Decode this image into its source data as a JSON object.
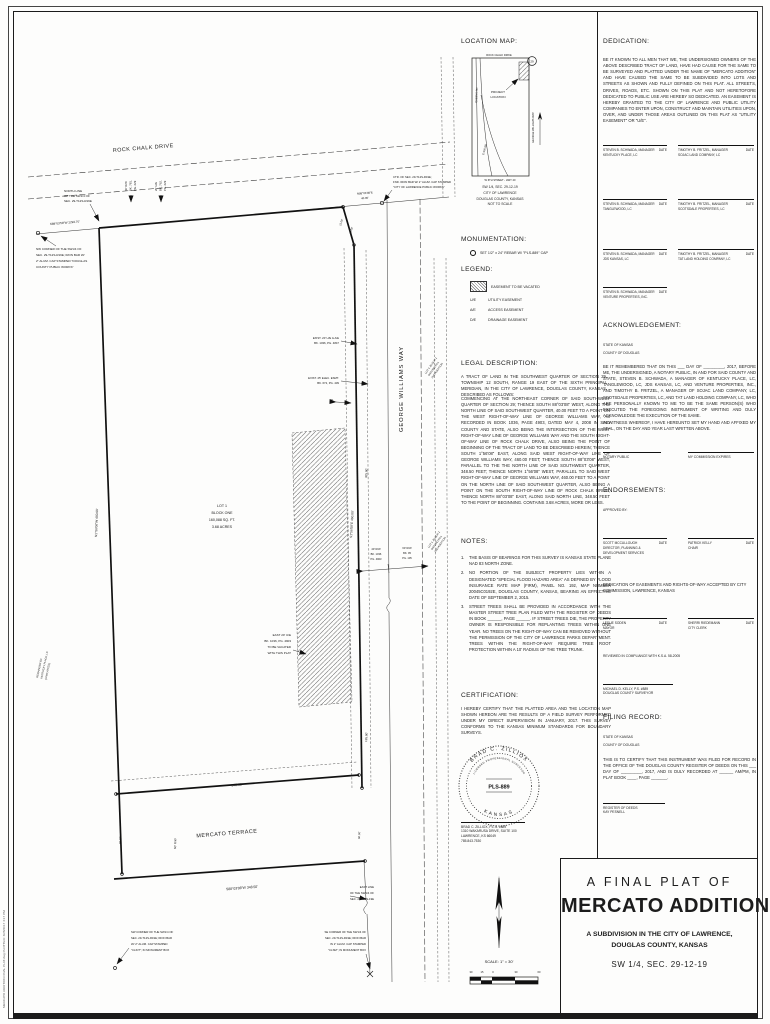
{
  "sheet": {
    "plot_stamp": "MERCATO ADDITION FINAL PLAT.dwg    PLOTTED: 3/28/2017 3:17 PM"
  },
  "labels": {
    "date": "DATE"
  },
  "location_map": {
    "title": "LOCATION MAP:",
    "road_top": "ROCK CHALK DRIVE",
    "badge": "29",
    "project_1": "PROJECT",
    "project_2": "LOCATION",
    "street_right": "GEORGE WILLIAMS WAY",
    "street_left_a": "QUEENS RD",
    "street_left_b": "E 900 RD",
    "road_bottom": "W 6TH STREET - HWY 40",
    "caption": [
      "SW 1/4, SEC. 29-12-19",
      "CITY OF LAWRENCE",
      "DOUGLAS COUNTY, KANSAS",
      "NOT TO SCALE"
    ]
  },
  "monumentation": {
    "title": "MONUMENTATION:",
    "item": "SET 1/2\" x 24\" REBAR W/ \"PLS-889\" CAP"
  },
  "legend": {
    "title": "LEGEND:",
    "vacated": "EASEMENT TO BE VACATED",
    "items": [
      {
        "code": "U/E",
        "label": "UTILITY EASEMENT"
      },
      {
        "code": "A/E",
        "label": "ACCESS EASEMENT"
      },
      {
        "code": "D/E",
        "label": "DRAINAGE EASEMENT"
      }
    ]
  },
  "legal": {
    "title": "LEGAL DESCRIPTION:",
    "p1": "A TRACT OF LAND IN THE SOUTHWEST QUARTER OF SECTION 29, TOWNSHIP 12 SOUTH, RANGE 19 EAST OF THE SIXTH PRINCIPAL MERIDIAN, IN THE CITY OF LAWRENCE, DOUGLAS COUNTY, KANSAS, DESCRIBED AS FOLLOWS:",
    "p2": "COMMENCING AT THE NORTHEAST CORNER OF SAID SOUTHWEST QUARTER OF SECTION 29; THENCE SOUTH 88°03'08\" WEST, ALONG THE NORTH LINE OF SAID SOUTHWEST QUARTER, 40.00 FEET TO A POINT ON THE WEST RIGHT-OF-WAY LINE OF GEORGE WILLIAMS WAY, AS RECORDED IN BOOK 1036, PAGE 4903, DATED MAY 4, 2008 IN SAID COUNTY AND STATE, ALSO BEING THE INTERSECTION OF THE WEST RIGHT-OF-WAY LINE OF GEORGE WILLIAMS WAY AND THE SOUTH RIGHT-OF-WAY LINE OF ROCK CHALK DRIVE, ALSO BEING THE POINT OF BEGINNING OF THE TRACT OF LAND TO BE DESCRIBED HEREIN; THENCE SOUTH 1°56'08\" EAST, ALONG SAID WEST RIGHT-OF-WAY LINE OF GEORGE WILLIAMS WAY, 460.00 FEET; THENCE SOUTH 88°03'08\" WEST, PARALLEL TO THE THE NORTH LINE OF SAID SOUTHWEST QUARTER, 348.50 FEET; THENCE NORTH 1°56'08\" WEST, PARALLEL TO SAID WEST RIGHT-OF-WAY LINE OF GEORGE WILLIAMS WAY, 460.00 FEET TO A POINT ON THE NORTH LINE OF SAID SOUTHWEST QUARTER, ALSO BEING A POINT ON THE SOUTH RIGHT-OF-WAY LINE OF ROCK CHALK DRIVE; THENCE NORTH 88°03'08\" EAST, ALONG SAID NORTH LINE, 348.50 FEET TO THE POINT OF BEGINNING. CONTAINS 3.68 ACRES, MORE OR LESS."
  },
  "notes": {
    "title": "NOTES:",
    "items": [
      {
        "n": "1.",
        "t": "THE BASIS OF BEARINGS FOR THIS SURVEY IS KANSAS STATE PLANE NAD 83 NORTH ZONE."
      },
      {
        "n": "2.",
        "t": "NO PORTION OF THE SUBJECT PROPERTY LIES WITHIN A DESIGNATED \"SPECIAL FLOOD HAZARD AREA\" AS DEFINED BY FLOOD INSURANCE RATE MAP (FIRM), PANEL NO. 192, MAP NUMBER 20045C0192E, DOUGLAS COUNTY, KANSAS, BEARING AN EFFECTIVE DATE OF SEPTEMBER 2, 2015."
      },
      {
        "n": "3.",
        "t": "STREET TREES SHALL BE PROVIDED IN ACCORDANCE WITH THE MASTER STREET TREE PLAN FILED WITH THE REGISTER OF DEEDS IN BOOK ______, PAGE ______.  IF STREET TREES DIE, THE PROPERTY OWNER IS RESPONSIBLE FOR REPLANTING TREES WITHIN ONE YEAR.  NO TREES ON THE RIGHT-OF-WAY CAN BE REMOVED WITHOUT THE PERMISSION OF THE CITY OF LAWRENCE PARKS DEPARTMENT.  TREES WITHIN THE RIGHT-OF-WAY REQUIRE TREE ROOT PROTECTION WITHIN A 10' RADIUS OF THE TREE TRUNK."
      }
    ]
  },
  "certification": {
    "title": "CERTIFICATION:",
    "body": "I HEREBY CERTIFY THAT THE PLATTED AREA AND THE LOCATION MAP SHOWN HEREON ARE THE RESULTS OF A FIELD SURVEY PERFORMED UNDER MY DIRECT SUPERVISION IN JANUARY, 2017. THIS SURVEY CONFORMS TO THE KANSAS MINIMUM STANDARDS FOR BOUNDARY SURVEYS.",
    "seal": {
      "arc_top": "BRAD C. ZILLIOX",
      "arc_inner": "LICENSED PROFESSIONAL SURVEYOR",
      "center": "PLS-889",
      "arc_bottom": "KANSAS"
    },
    "surveyor": [
      "BRAD C. ZILLIOX, P.L.S. #889",
      "1310 WAKARUSA DRIVE, SUITE 100",
      "LAWRENCE, KS 66049",
      "785.843.7530"
    ]
  },
  "dedication": {
    "title": "DEDICATION:",
    "body": "BE IT KNOWN TO ALL MEN THAT WE, THE UNDERSIGNED OWNERS OF THE ABOVE DESCRIBED TRACT OF LAND, HAVE HAD CAUSE FOR THE SAME TO BE SURVEYED AND PLATTED UNDER THE NAME OF \"MERCATO ADDITION\" AND HAVE CAUSED THE SAME TO BE SUBDIVIDED INTO LOTS AND STREETS AS SHOWN AND FULLY DEFINED ON THIS PLAT. ALL STREETS, DRIVES, ROADS, ETC. SHOWN ON THIS PLAT AND NOT HERETOFORE DEDICATED TO PUBLIC USE ARE HEREBY SO DEDICATED. AN EASEMENT IS HEREBY GRANTED TO THE CITY OF LAWRENCE AND PUBLIC UTILITY COMPANIES TO ENTER UPON, CONSTRUCT AND MAINTAIN UTILITIES UPON, OVER, AND UNDER THOSE AREAS OUTLINED ON THIS PLAT AS \"UTILITY EASEMENT\" OR \"U/E\"."
  },
  "signatures": {
    "rows": [
      {
        "left": {
          "name": "STEVEN B. SCHWADA, MANAGER",
          "company": "KENTUCKY PLACE, LC"
        },
        "right": {
          "name": "TIMOTHY B. FRITZEL, MANAGER",
          "company": "SOJAC LAND COMPANY, LC"
        }
      },
      {
        "left": {
          "name": "STEVEN B. SCHWADA, MANAGER",
          "company": "TANGLEWOOD, LC"
        },
        "right": {
          "name": "TIMOTHY B. FRITZEL, MANAGER",
          "company": "SCOTSDALE PROPERTIES, LC"
        }
      },
      {
        "left": {
          "name": "STEVEN B. SCHWADA, MANAGER",
          "company": "JDS KANSAS, LC"
        },
        "right": {
          "name": "TIMOTHY B. FRITZEL, MANAGER",
          "company": "TAT LAND HOLDING COMPANY, LC"
        }
      },
      {
        "left": {
          "name": "STEVEN B. SCHWADA, MANAGER",
          "company": "VENTURE PROPERTIES, INC."
        }
      }
    ]
  },
  "acknowledgement": {
    "title": "ACKNOWLEDGEMENT:",
    "state": "STATE OF KANSAS",
    "county": "COUNTY OF DOUGLAS",
    "body": "BE IT REMEMBERED THAT ON THIS ___ DAY OF _________, 2017, BEFORE ME, THE UNDERSIGNED, A NOTARY PUBLIC, IN AND FOR SAID COUNTY AND STATE, STEVEN B. SCHWADA, A MANAGER OF KENTUCKY PLACE, LC, TANGLEWOOD, LC, JDS KANSAS, LC, AND VENTURE PROPERTIES, INC., AND TIMOTHY B. FRITZEL, A MANAGER OF SOJAC LAND COMPANY, LC, SCOTSDALE PROPERTIES, LC, AND TAT LAND HOLDING COMPANY, LC, WHO ARE PERSONALLY KNOWN TO ME TO BE THE SAME PERSON(S) WHO EXECUTED THE FOREGOING INSTRUMENT OF WRITING AND DULY ACKNOWLEDGE THE EXECUTION OF THE SAME.",
    "witness": "IN WITNESS WHEREOF, I HAVE HEREUNTO SET MY HAND AND AFFIXED MY SEAL, ON THE DAY AND YEAR LAST WRITTEN ABOVE.",
    "notary": "NOTARY PUBLIC",
    "commission": "MY COMMISSION EXPIRES"
  },
  "endorsements": {
    "title": "ENDORSEMENTS:",
    "approved": "APPROVED BY:",
    "row1": {
      "left": {
        "name": "SCOTT MCCULLOUGH",
        "role1": "DIRECTOR, PLANNING &",
        "role2": "DEVELOPMENT SERVICES"
      },
      "right": {
        "name": "PATRICK KELLY",
        "role1": "CHAIR"
      }
    },
    "accept_note": "DEDICATION OF EASEMENTS AND RIGHTS-OF-WAY ACCEPTED BY CITY COMMISSION, LAWRENCE, KANSAS",
    "row2": {
      "left": {
        "name": "LESLIE SODEN",
        "role1": "MAYOR"
      },
      "right": {
        "name": "SHERRI RIEDEMANN",
        "role1": "CITY CLERK"
      }
    },
    "ksa": "REVIEWED IN COMPLIANCE WITH K.S.A. 58-2005",
    "surveyor": {
      "name": "MICHAEL D. KELLY, P.S. #889",
      "role": "DOUGLAS COUNTY SURVEYOR"
    }
  },
  "filing": {
    "title": "FILING RECORD:",
    "state": "STATE OF KANSAS",
    "county": "COUNTY OF DOUGLAS",
    "body": "THIS IS TO CERTIFY THAT THIS INSTRUMENT WAS FILED FOR RECORD IN THE OFFICE OF THE DOUGLAS COUNTY REGISTER OF DEEDS ON THIS ___ DAY OF _________, 2017, AND IS DULY RECORDED AT ______ AM/PM, IN PLAT BOOK ____, PAGE _______.",
    "register": "REGISTER OF DEEDS",
    "register_name": "KAY PESNELL"
  },
  "title_block": {
    "line1": "A FINAL PLAT OF",
    "name": "MERCATO ADDITION",
    "sub1": "A SUBDIVISION IN THE CITY OF LAWRENCE,",
    "sub2": "DOUGLAS COUNTY, KANSAS",
    "section": "SW 1/4, SEC. 29-12-19"
  },
  "scale_block": {
    "label": "SCALE: 1\" = 30'",
    "ticks": [
      "30",
      "15",
      "0",
      "30",
      "60"
    ]
  },
  "plat": {
    "rock_chalk": "ROCK CHALK DRIVE",
    "george_williams": "GEORGE WILLIAMS WAY",
    "mercato_terrace": "MERCATO TERRACE",
    "lot_lines": [
      "LOT 1",
      "BLOCK ONE",
      "160,088 SQ. FT.",
      "3.68 ACRES"
    ],
    "north_line_note": [
      "NORTH LINE",
      "OF THE SW1/4 OF",
      "SEC. 29-T12S-R19E"
    ],
    "north_line_bearing": "S88°03'58\"W  2293.70'",
    "nw_corner_note": [
      "NW CORNER OF THE SW1/4 OF",
      "SEC. 29-T12S-R19E; IRON BAR W/",
      "2\" ALUM. CAP STAMPED \"DOUGLAS",
      "COUNTY PUBLIC WORKS\""
    ],
    "ctr_note": [
      "CTR. OF SEC. 29-T12S-R19E;",
      "FND. IRON BAR W/ 2\" ALUM. CAP STAMPED",
      "\"CITY OF LAWRENCE PUBLIC WORKS\""
    ],
    "ctr_bearing": "N88°03'08\"E",
    "ctr_dist": "40.00'",
    "clip_dim1": "15.00'",
    "clip_dim2": "25.00'",
    "rcd_rw_note": [
      "60' R/W",
      "BK. 781,",
      "PG. 629"
    ],
    "rcd_ue_note": [
      "20' U/E",
      "BK. 762,",
      "PG. 629"
    ],
    "west_dim": "N1°56'08\"W  460.00'",
    "east_dim": "S1°56'08\"E  460.00'",
    "east_seg": "325.00'",
    "east_seg2": "135.00'",
    "exist_ue_note": [
      "EXIST. 20' U/E & A/E",
      "BK. 1036, PG. 4847"
    ],
    "exist_elec_note": [
      "EXIST. 25' ELEC. ESMT.",
      "BK. 672, PG. 439"
    ],
    "ten_dim": "10'",
    "rw40_note": [
      "40' R/W",
      "BK. 1036",
      "PG. 4903"
    ],
    "rw60_note": [
      "60' R/W",
      "BK. 95",
      "PG. 105"
    ],
    "vacate_note": [
      "EAST 20' U/E",
      "BK. 1036, PG. 4903",
      "TO BE VACATED",
      "WITH THIS PLAT"
    ],
    "remainder_note": [
      "REMAINDER OF",
      "KENTUCKY PLACE, LC",
      "(UNPLATTED)"
    ],
    "adj_lot_north": [
      "LOT 4, BLOCK 1",
      "OXFORD HILL",
      "2ND ADDITION"
    ],
    "adj_lot_south": [
      "LOT 1, BLOCK 1",
      "OXFORD HILL",
      "2ND ADDITION"
    ],
    "south_dim_top": "348.50'",
    "south_dim": "S88°03'08\"W  348.50'",
    "street_rw": "60' R/W",
    "sixty_w": "60.00'",
    "sixty_e": "60.00'",
    "east_line_note": [
      "EAST LINE",
      "OF THE SW1/4 OF",
      "SEC. 29-T12S-19E"
    ],
    "se_corner_note": [
      "SE CORNER OF THE SW1/4 OF",
      "SEC. 29-T12S-R19E; IRON BAR",
      "IN 2\" ALUM. CAP STAMPED",
      "\"CLSM\"; IN MONUMENT BOX"
    ],
    "sw_corner_note": [
      "SW CORNER OF THE SW1/4 OF",
      "SEC. 29-T12S-R19E; IRON BAR",
      "W/ 2\" ALUM. CAP STAMPED",
      "\"CLINT\"; IN MONUMENT BOX"
    ]
  }
}
